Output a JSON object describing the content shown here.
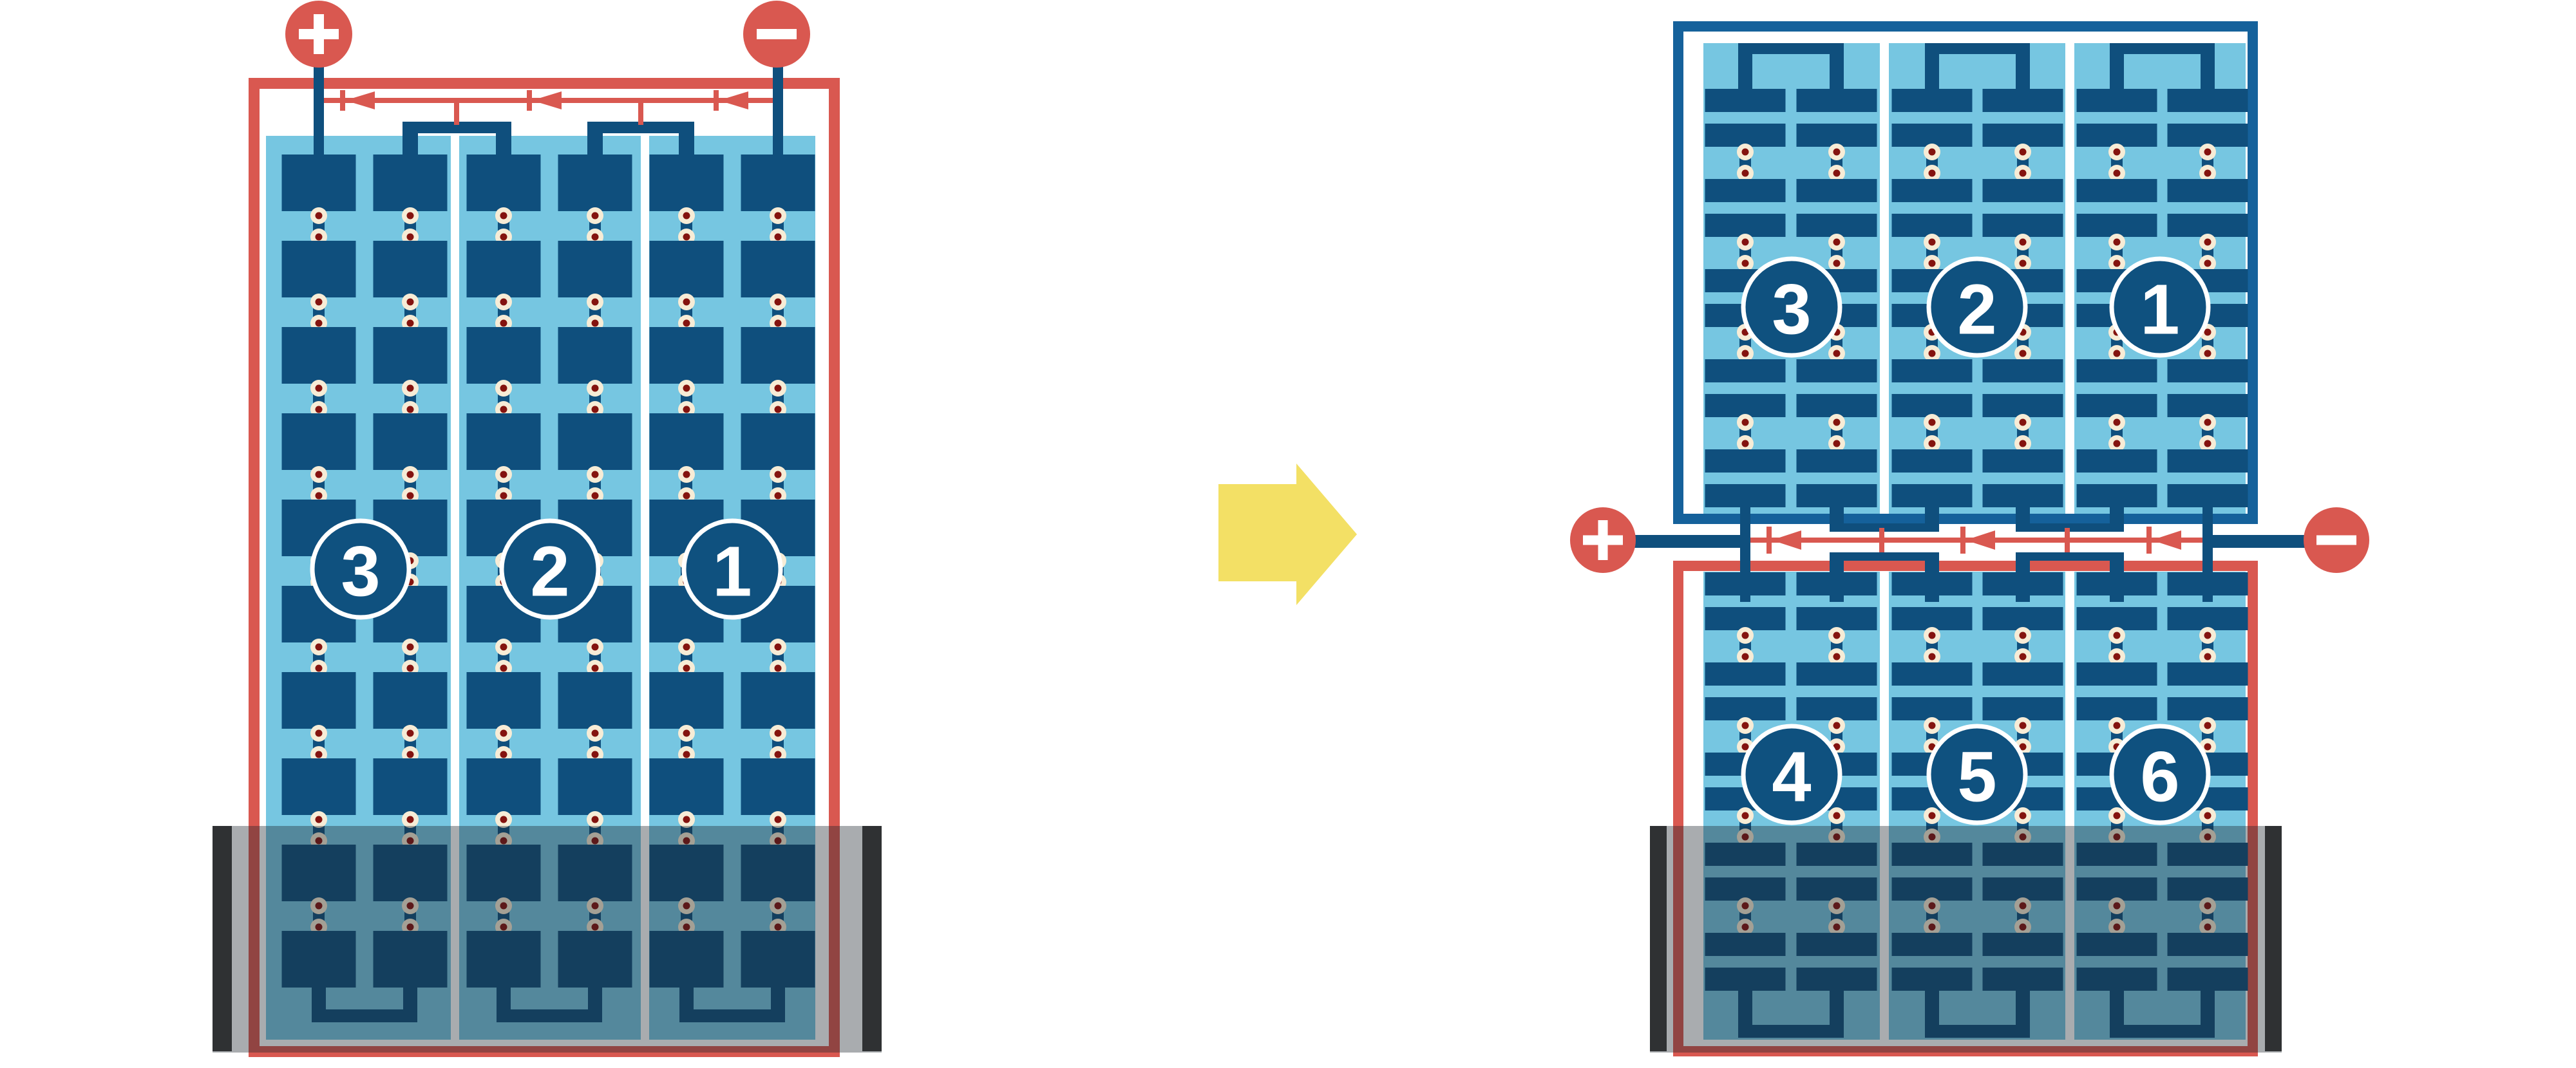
{
  "left_panel": {
    "module_labels": [
      "3",
      "2",
      "1"
    ],
    "positive_terminal": "+",
    "negative_terminal": "−"
  },
  "transform_arrow": {
    "icon": "right-arrow-icon"
  },
  "right_top_panel": {
    "module_labels": [
      "3",
      "2",
      "1"
    ]
  },
  "right_bottom_panel": {
    "module_labels": [
      "4",
      "5",
      "6"
    ]
  },
  "junction": {
    "positive_terminal": "+",
    "negative_terminal": "−"
  },
  "colors": {
    "red": "#D95850",
    "panel_navy": "#0F4F7D",
    "frame_blue": "#15619B",
    "light_blue": "#76C6E1",
    "badge_fill": "#0F517F",
    "badge_ring": "#FFFFFF",
    "dot_outer": "#F7ECD6",
    "dot_inner": "#84130F",
    "flood_overlay": "rgba(28,38,44,0.38)",
    "flood_bar": "#3A3937",
    "arrow_yellow": "#F3E065",
    "white": "#FFFFFF"
  }
}
